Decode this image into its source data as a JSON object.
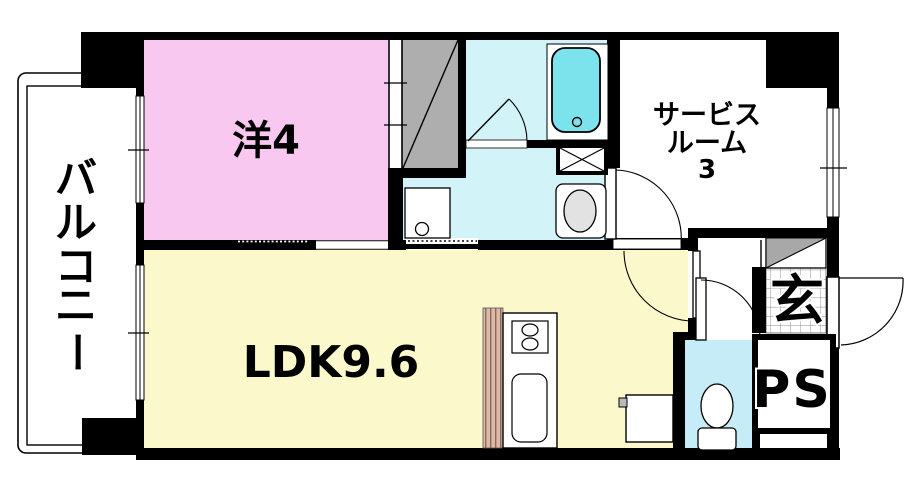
{
  "floor_plan": {
    "type": "japanese-apartment-floor-plan",
    "rooms": {
      "balcony": {
        "label": "バルコニー",
        "chars": [
          "バ",
          "ル",
          "コ",
          "ニ",
          "ー"
        ]
      },
      "western_room": {
        "label": "洋4"
      },
      "ldk": {
        "label": "LDK9.6"
      },
      "service_room": {
        "label": "サービスルーム3",
        "lines": [
          "サービス",
          "ルーム",
          "3"
        ]
      },
      "entrance": {
        "label": "玄"
      },
      "pipe_space": {
        "label": "PS"
      }
    },
    "fixtures": [
      "bathtub",
      "bath-door",
      "closet",
      "closet-sliding-door",
      "washing-machine",
      "washbasin",
      "duct-box",
      "kitchen-counter",
      "kitchen-stove",
      "kitchen-sink",
      "water-heater",
      "toilet",
      "shoe-cabinet",
      "entrance-door",
      "balcony-window",
      "service-room-window"
    ],
    "colors": {
      "wall": "#000000",
      "western_room_fill": "#f8c8f1",
      "ldk_fill": "#fbf9cb",
      "bath_fill": "#d2f3f7",
      "bathtub_fill": "#7ce2ec",
      "toilet_fill": "#c6edf7",
      "closet_fill": "#aeaeae",
      "shoe_cabinet_fill": "#a8a8a8",
      "kitchen_stripe_fill": "#dcb9a8",
      "fixture_gray": "#e2e2e2"
    }
  }
}
